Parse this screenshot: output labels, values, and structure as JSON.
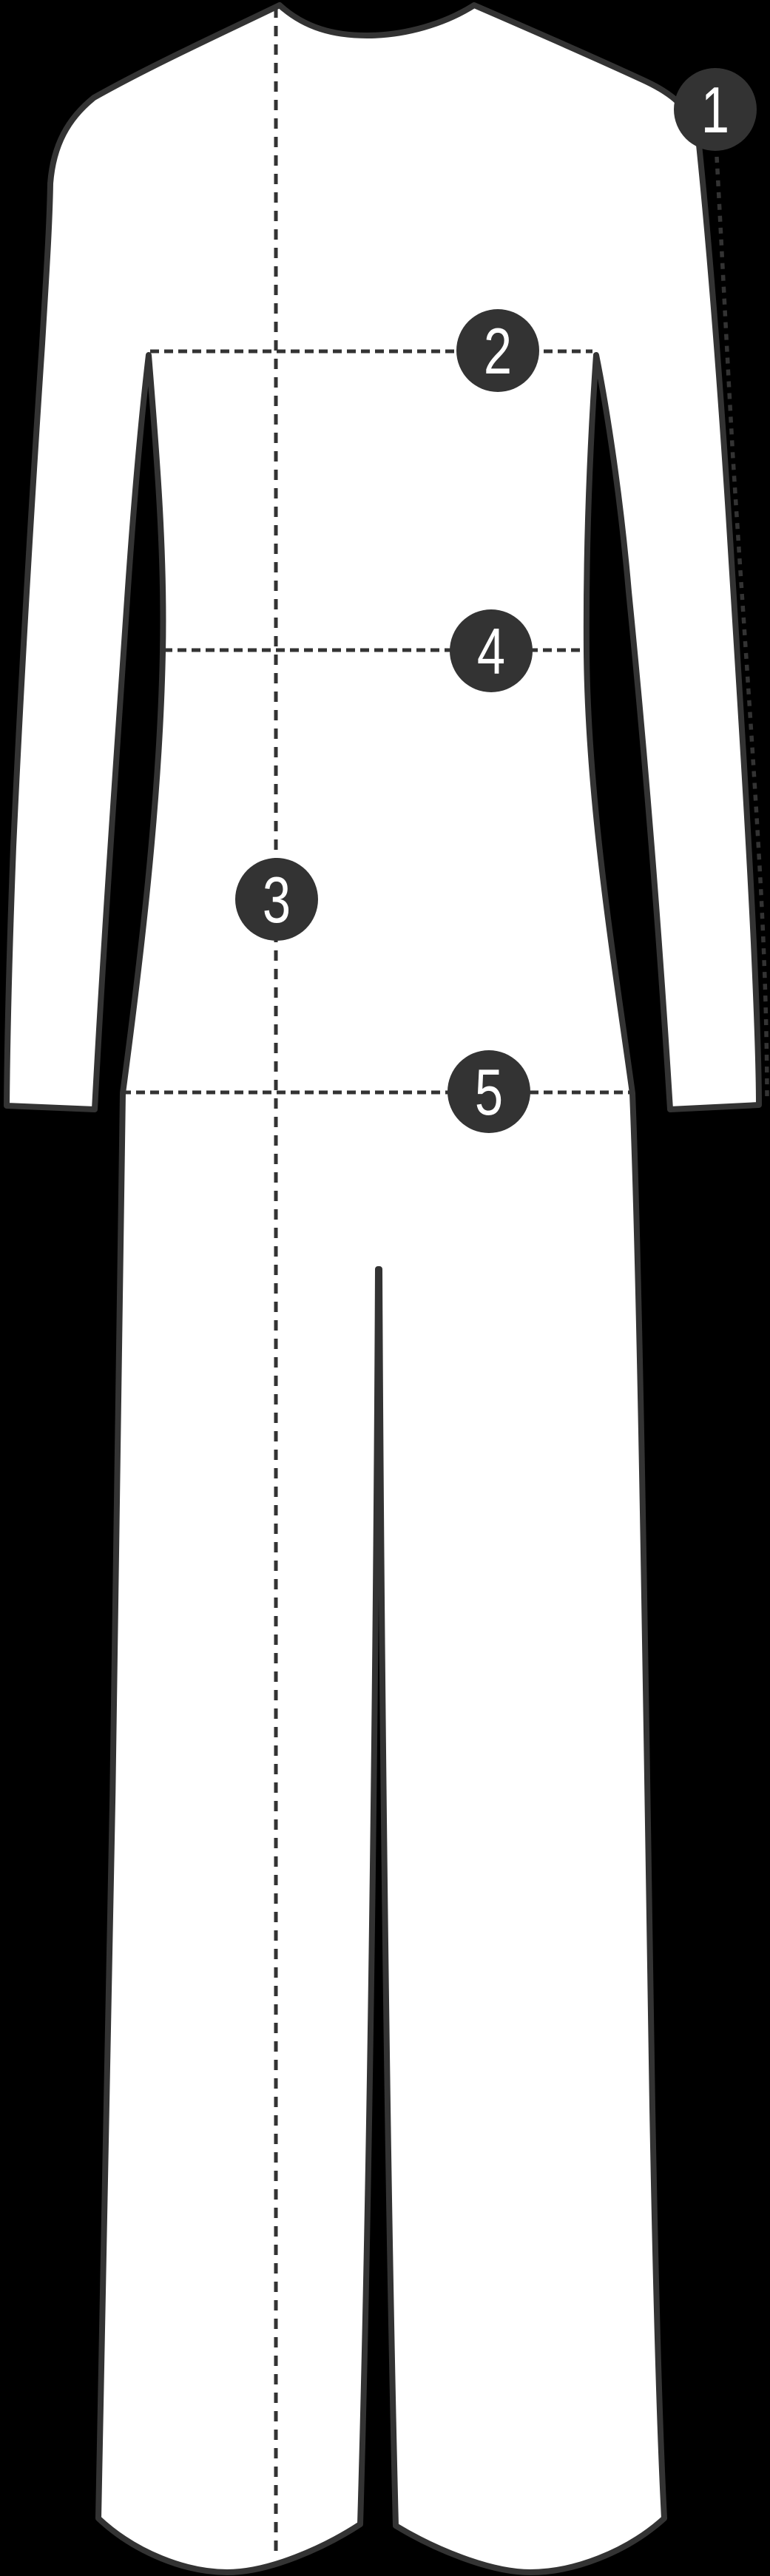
{
  "diagram": {
    "description": "Jumpsuit flat sketch with numbered measurement points",
    "markers": [
      {
        "label": "1"
      },
      {
        "label": "2"
      },
      {
        "label": "3"
      },
      {
        "label": "4"
      },
      {
        "label": "5"
      }
    ]
  },
  "colors": {
    "background": "#000000",
    "garment-fill": "#ffffff",
    "ink": "#333333",
    "marker-fill": "#333333",
    "marker-number": "#ffffff"
  }
}
